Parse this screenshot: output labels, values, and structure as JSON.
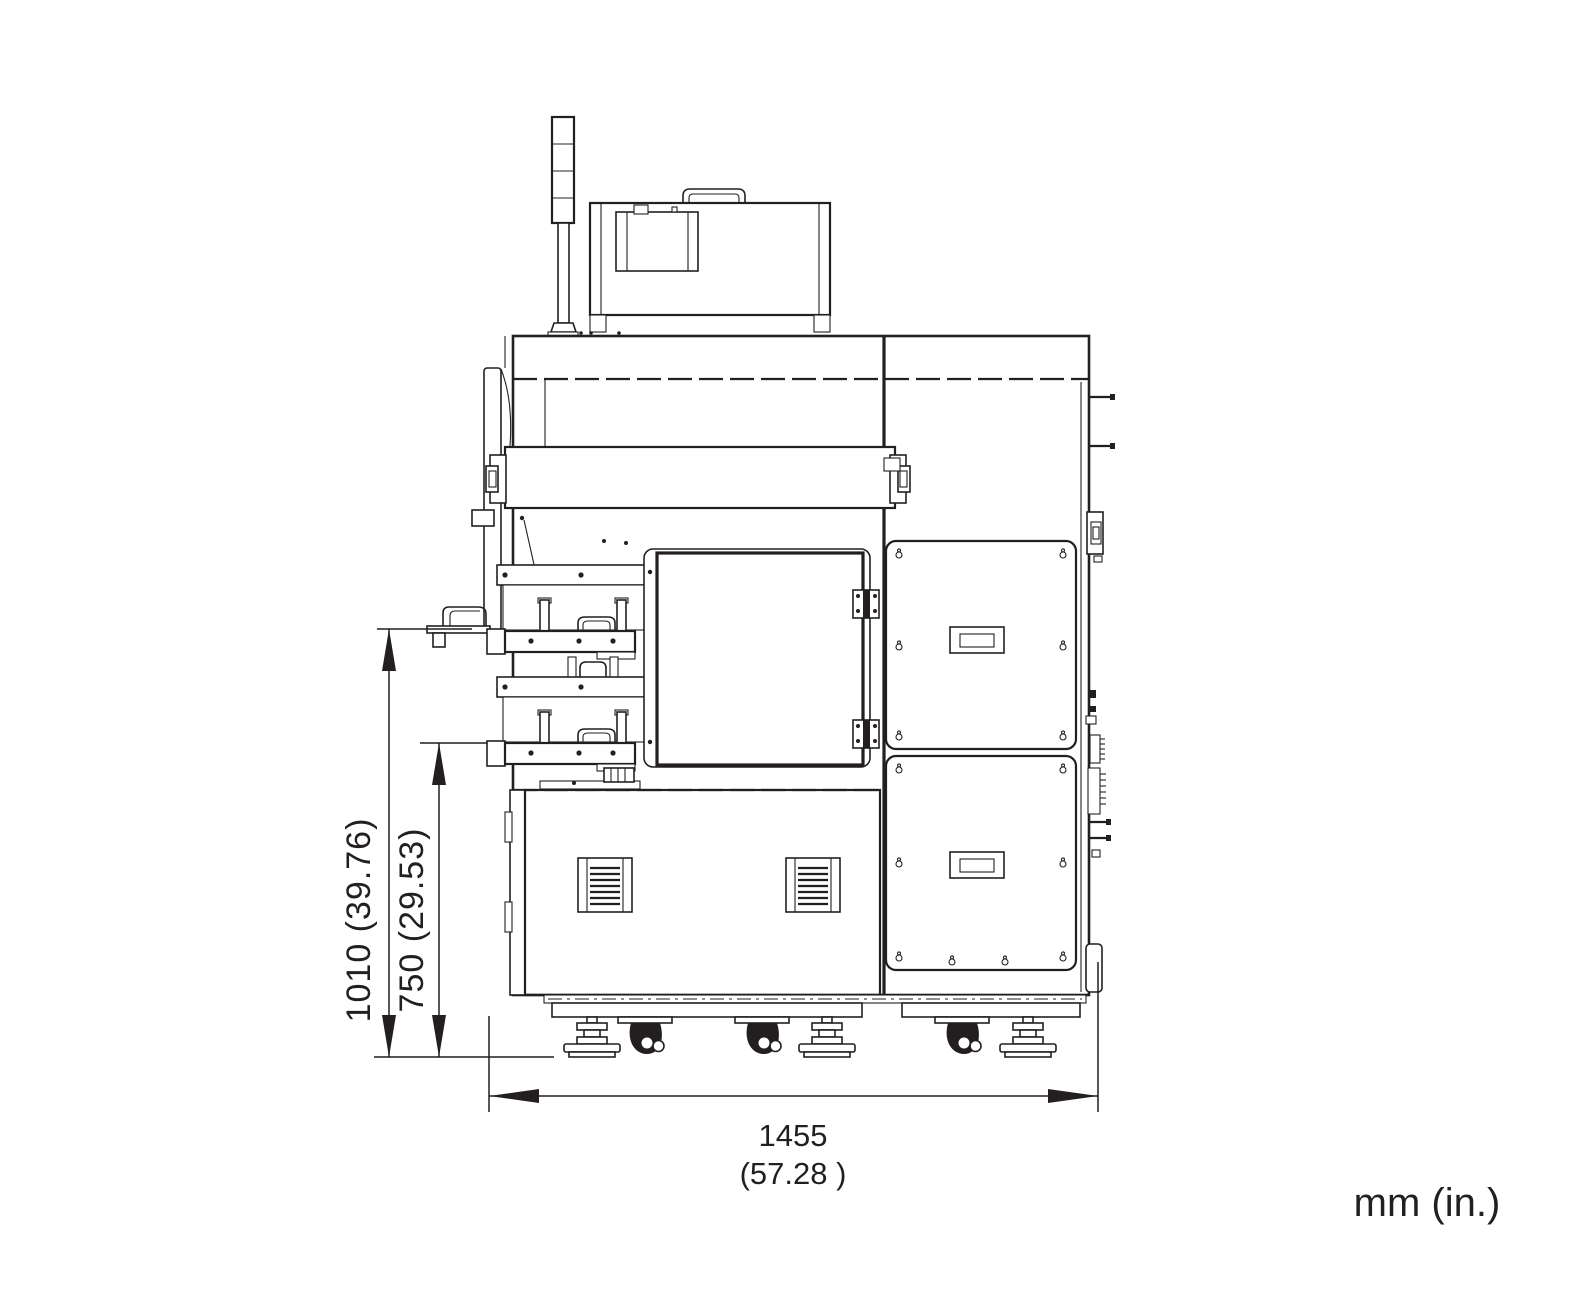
{
  "page": {
    "background": "#ffffff",
    "line_color": "#231f20"
  },
  "annotations": {
    "height_total": "1010 (39.76)",
    "height_table": "750 (29.53)",
    "width_value": "1455",
    "width_inches": "(57.28 )",
    "units": "mm (in.)"
  }
}
